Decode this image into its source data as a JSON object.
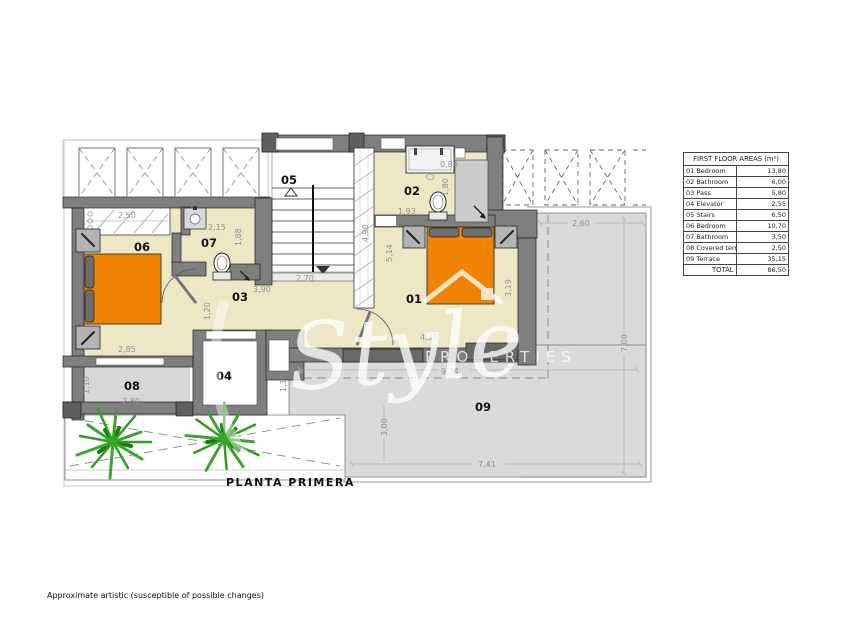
{
  "captions": {
    "plan_title": "PLANTA PRIMERA",
    "disclaimer": "Approximate artistic (susceptible of possible changes)"
  },
  "watermark": {
    "script": "Style",
    "caps": "PROPERTIES"
  },
  "areas_table": {
    "header": "FIRST FLOOR AREAS (m²)",
    "rows": [
      {
        "label": "01 Bedroom",
        "value": "13,80"
      },
      {
        "label": "02 Bathroom",
        "value": "6,00"
      },
      {
        "label": "03 Pass",
        "value": "5,80"
      },
      {
        "label": "04 Elevator",
        "value": "2,55"
      },
      {
        "label": "05 Stairs",
        "value": "6,50"
      },
      {
        "label": "06 Bedroom",
        "value": "10,70"
      },
      {
        "label": "07 Bathroom",
        "value": "3,50"
      },
      {
        "label": "08 Covered terrace",
        "value": "2,50"
      },
      {
        "label": "09 Terrace",
        "value": "35,15"
      }
    ],
    "total_label": "TOTAL",
    "total_value": "86,50"
  },
  "room_labels": [
    "01",
    "02",
    "03",
    "04",
    "05",
    "06",
    "07",
    "08",
    "09"
  ],
  "dims": {
    "wardrobe": "2,50",
    "pass_top": "2,15",
    "bath7_h": "1,88",
    "bath2_w": "0,80",
    "bath2_h": "1,80",
    "bath2_b": "1,93",
    "bed2_h": "5,14",
    "stair_window": "4,90",
    "stairs_w": "2,70",
    "pass_w": "3,90",
    "pass_h": "1,20",
    "bed6_w": "2,85",
    "terr8_w": "2,80",
    "terr8_h": "1,10",
    "terr9_h1": "1,10",
    "bed1_h": "3,19",
    "bed1_w": "4,32",
    "terr9_top": "2,60",
    "terr9_w": "9,34",
    "terr9_h": "3,00",
    "terr9_b": "7,41",
    "terr9_r": "7,00"
  },
  "colors": {
    "floor_cream": "#ece8c6",
    "bed_orange": "#f08300",
    "wall_gray": "#7f7f7f",
    "terrace_gray": "#dadada",
    "plant_green": "#2f9e23"
  }
}
